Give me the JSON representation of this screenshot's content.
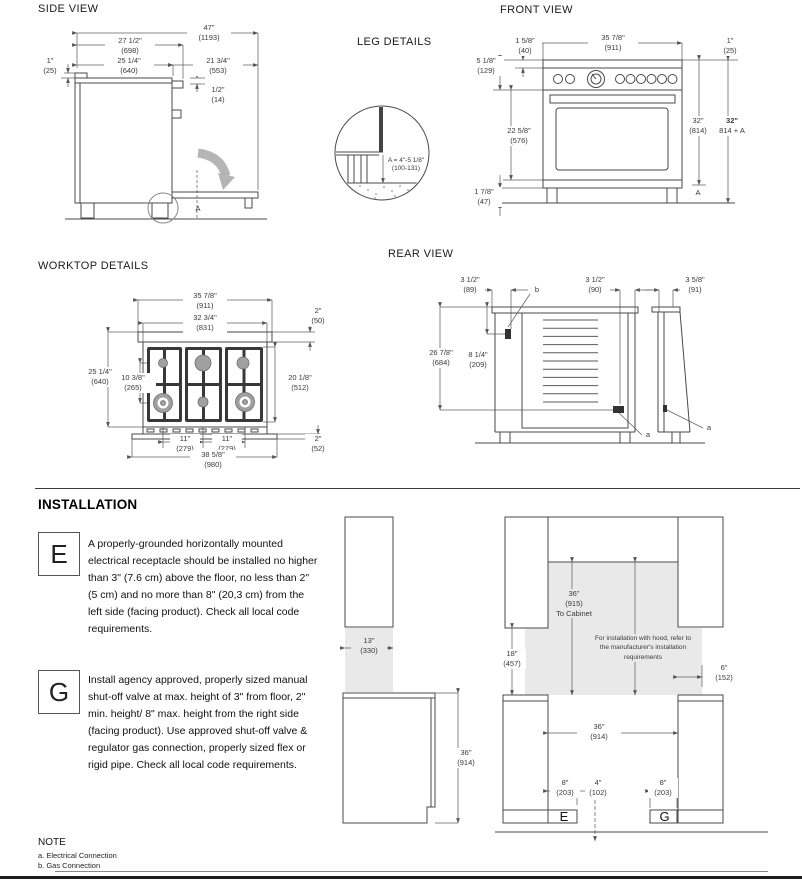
{
  "side_view": {
    "title": "SIDE VIEW",
    "d1193": {
      "in": "47\"",
      "mm": "(1193)"
    },
    "d698": {
      "in": "27 1/2\"",
      "mm": "(698)"
    },
    "d640": {
      "in": "25 1/4\"",
      "mm": "(640)"
    },
    "d25": {
      "in": "1\"",
      "mm": "(25)"
    },
    "d553": {
      "in": "21 3/4\"",
      "mm": "(553)"
    },
    "d14": {
      "in": "1/2\"",
      "mm": "(14)"
    },
    "a_label": "A"
  },
  "leg_details": {
    "title": "LEG DETAILS",
    "formula": "A = 4\"-5 1/8\"",
    "range": "(100-131)"
  },
  "front_view": {
    "title": "FRONT VIEW",
    "d911": {
      "in": "35 7/8\"",
      "mm": "(911)"
    },
    "d40": {
      "in": "1 5/8\"",
      "mm": "(40)"
    },
    "d25": {
      "in": "1\"",
      "mm": "(25)"
    },
    "d129": {
      "in": "5 1/8\"",
      "mm": "(129)"
    },
    "d576": {
      "in": "22 5/8\"",
      "mm": "(576)"
    },
    "d47": {
      "in": "1 7/8\"",
      "mm": "(47)"
    },
    "d814": {
      "in": "32\"",
      "mm": "(814)"
    },
    "d814a": {
      "in": "32\"",
      "mm": "814 + A"
    },
    "a_label": "A"
  },
  "worktop": {
    "title": "WORKTOP DETAILS",
    "d911": {
      "in": "35 7/8\"",
      "mm": "(911)"
    },
    "d831": {
      "in": "32 3/4\"",
      "mm": "(831)"
    },
    "d50": {
      "in": "2\"",
      "mm": "(50)"
    },
    "d640": {
      "in": "25 1/4\"",
      "mm": "(640)"
    },
    "d265": {
      "in": "10 3/8\"",
      "mm": "(265)"
    },
    "d512": {
      "in": "20 1/8\"",
      "mm": "(512)"
    },
    "d279a": {
      "in": "11\"",
      "mm": "(279)"
    },
    "d279b": {
      "in": "11\"",
      "mm": "(279)"
    },
    "d52": {
      "in": "2\"",
      "mm": "(52)"
    },
    "d980": {
      "in": "38 5/8\"",
      "mm": "(980)"
    }
  },
  "rear_view": {
    "title": "REAR VIEW",
    "d89": {
      "in": "3 1/2\"",
      "mm": "(89)"
    },
    "d90": {
      "in": "3 1/2\"",
      "mm": "(90)"
    },
    "d91": {
      "in": "3 5/8\"",
      "mm": "(91)"
    },
    "d684": {
      "in": "26 7/8\"",
      "mm": "(684)"
    },
    "d209": {
      "in": "8 1/4\"",
      "mm": "(209)"
    },
    "label_b": "b",
    "label_a1": "a",
    "label_a2": "a"
  },
  "installation": {
    "title": "INSTALLATION",
    "e_key": "E",
    "e_text": "A properly-grounded horizontally mounted electrical receptacle should be installed no higher than 3\" (7.6 cm) above the floor, no less than 2\" (5 cm) and no more than 8\" (20,3 cm) from the left side (facing product). Check all local code requirements.",
    "g_key": "G",
    "g_text": "Install agency approved, properly sized manual shut-off valve at max. height of 3\" from floor, 2\" min. height/ 8\" max. height from the right side (facing product). Use approved shut-off valve & regulator gas connection, properly sized flex or rigid pipe. Check all local code requirements.",
    "left_diagram": {
      "d330": {
        "in": "13\"",
        "mm": "(330)"
      },
      "d914": {
        "in": "36\"",
        "mm": "(914)"
      }
    },
    "right_diagram": {
      "to_cabinet": {
        "in": "36\"",
        "mm": "(915)",
        "note": "To Cabinet"
      },
      "hood_note": "For installation with hood, refer to the manufacturer's installation requirements",
      "d457": {
        "in": "18\"",
        "mm": "(457)"
      },
      "d152": {
        "in": "6\"",
        "mm": "(152)"
      },
      "d914": {
        "in": "36\"",
        "mm": "(914)"
      },
      "d203a": {
        "in": "8\"",
        "mm": "(203)"
      },
      "d102": {
        "in": "4\"",
        "mm": "(102)"
      },
      "d203b": {
        "in": "8\"",
        "mm": "(203)"
      },
      "e_key": "E",
      "g_key": "G"
    }
  },
  "note": {
    "title": "NOTE",
    "item_a": "a. Electrical Connection",
    "item_b": "b. Gas Connection"
  }
}
